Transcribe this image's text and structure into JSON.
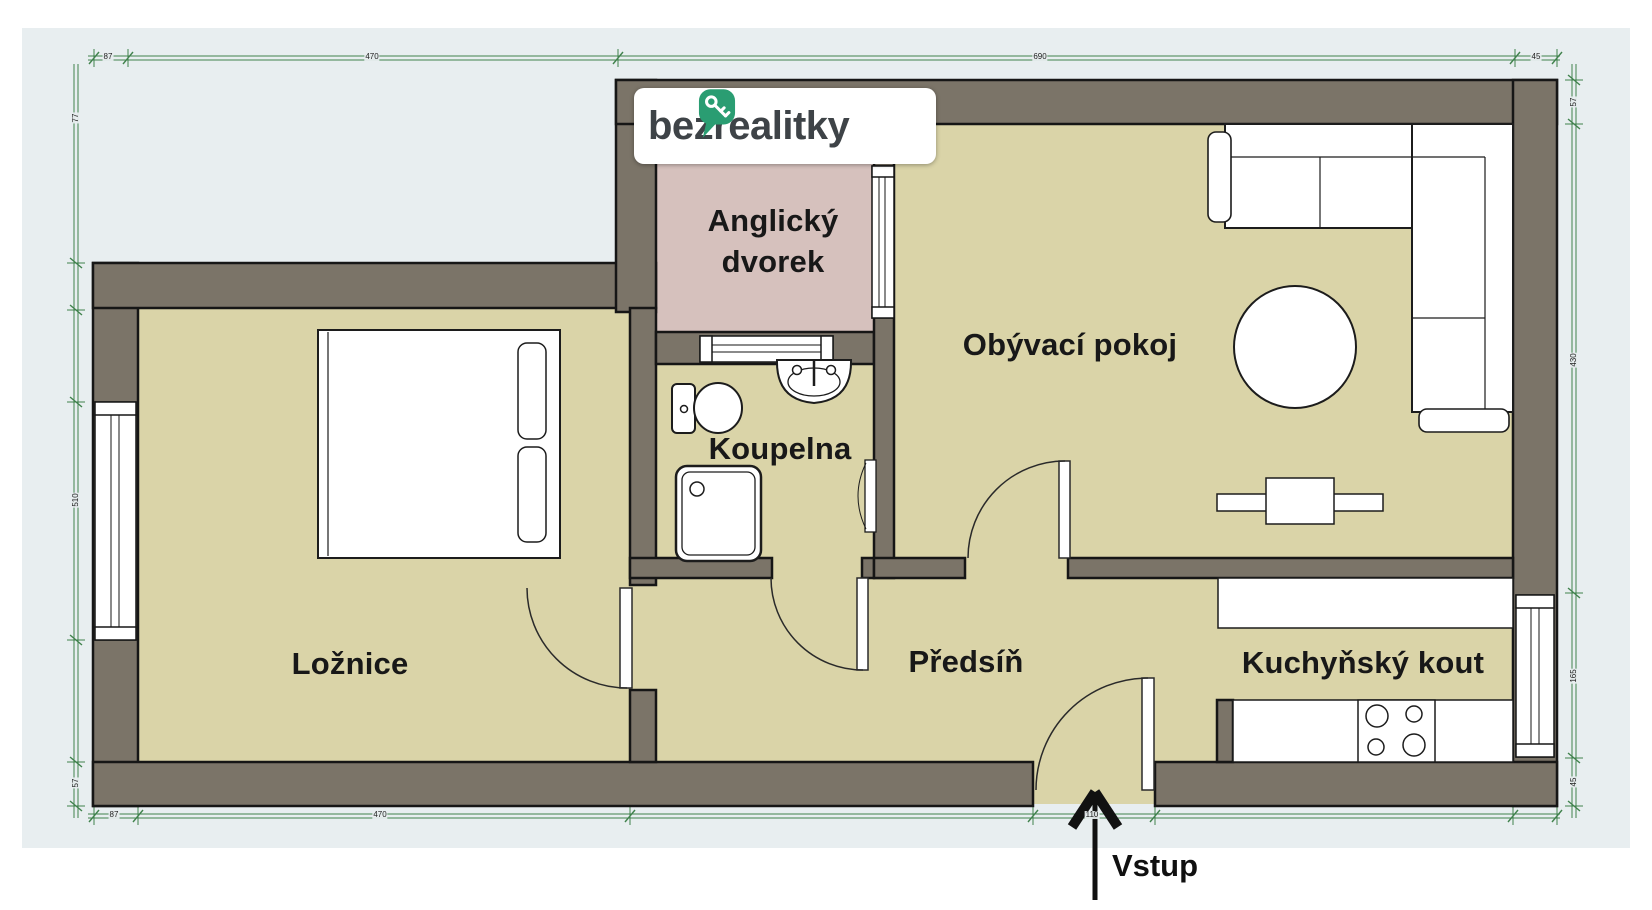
{
  "branding": {
    "logo_text": "bezrealitky"
  },
  "rooms": {
    "bedroom": {
      "label": "Ložnice"
    },
    "bathroom": {
      "label": "Koupelna"
    },
    "hallway": {
      "label": "Předsíň"
    },
    "living_room": {
      "label": "Obývací pokoj"
    },
    "kitchen": {
      "label": "Kuchyňský kout"
    },
    "courtyard": {
      "line1": "Anglický",
      "line2": "dvorek"
    }
  },
  "entrance": {
    "label": "Vstup"
  },
  "colors": {
    "wall": "#7b7468",
    "floor": "#dad4a8",
    "courtyard": "#d6c1bd",
    "background": "#e8eef0",
    "dimension": "#41824d",
    "outline": "#161616",
    "logo_green": "#2a9d72",
    "arrow": "#111111"
  },
  "dimension_lines": {
    "top": {
      "orient": "h",
      "pos": 58,
      "from": 88,
      "to": 1560,
      "ticks": [
        94,
        128,
        618,
        1515,
        1557
      ],
      "labels": [
        {
          "t": "87",
          "at": 108
        },
        {
          "t": "470",
          "at": 372
        },
        {
          "t": "690",
          "at": 1040
        },
        {
          "t": "45",
          "at": 1536
        }
      ]
    },
    "bottom": {
      "orient": "h",
      "pos": 816,
      "from": 88,
      "to": 1560,
      "ticks": [
        94,
        138,
        630,
        1033,
        1155,
        1513,
        1557
      ],
      "labels": [
        {
          "t": "87",
          "at": 114
        },
        {
          "t": "470",
          "at": 380
        },
        {
          "t": "110",
          "at": 1092
        }
      ]
    },
    "left": {
      "orient": "v",
      "pos": 76,
      "from": 64,
      "to": 818,
      "ticks": [
        263,
        310,
        402,
        640,
        762,
        806
      ],
      "labels": [
        {
          "t": "77",
          "at": 118
        },
        {
          "t": "510",
          "at": 500
        },
        {
          "t": "57",
          "at": 783
        }
      ]
    },
    "right": {
      "orient": "v",
      "pos": 1574,
      "from": 64,
      "to": 818,
      "ticks": [
        80,
        124,
        593,
        758,
        806
      ],
      "labels": [
        {
          "t": "57",
          "at": 102
        },
        {
          "t": "430",
          "at": 360
        },
        {
          "t": "165",
          "at": 676
        },
        {
          "t": "45",
          "at": 782
        }
      ]
    }
  }
}
